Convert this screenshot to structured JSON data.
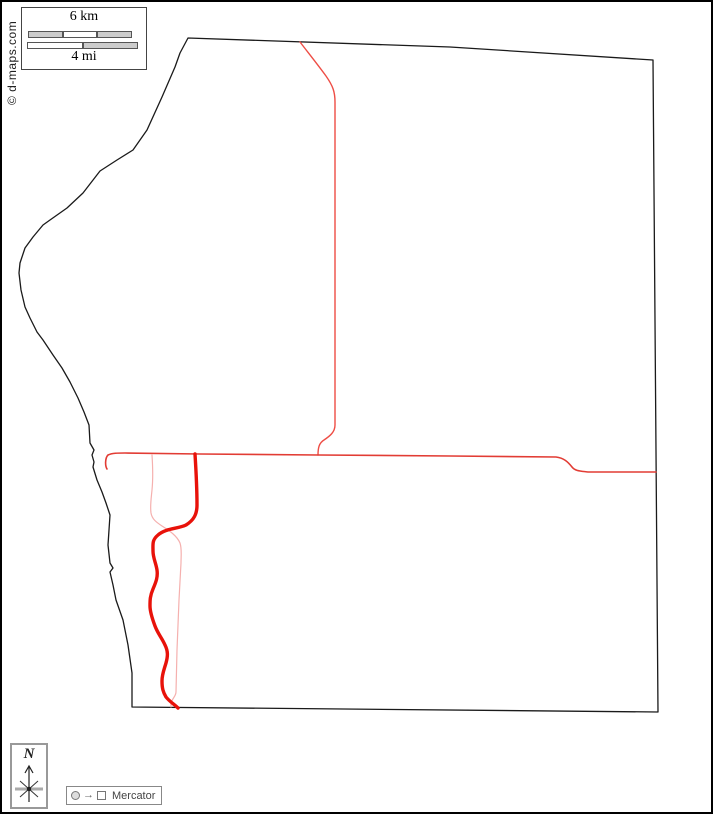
{
  "page": {
    "background": "#ffffff",
    "frame_color": "#000000"
  },
  "scale_box": {
    "km_label": "6 km",
    "mi_label": "4 mi",
    "km_segments": [
      "gray",
      "white",
      "gray"
    ],
    "mi_segments": [
      "white",
      "gray"
    ]
  },
  "copyright": {
    "text": "© d-maps.com"
  },
  "compass": {
    "label": "N"
  },
  "projection": {
    "transform_glyph": "→",
    "label": "Mercator"
  },
  "map": {
    "colors": {
      "boundary": "#1a1a1a",
      "highway_major": "#e8120a",
      "road_primary": "#e23c34",
      "road_secondary": "#ee4d45",
      "road_minor": "#f5b0ae"
    }
  }
}
